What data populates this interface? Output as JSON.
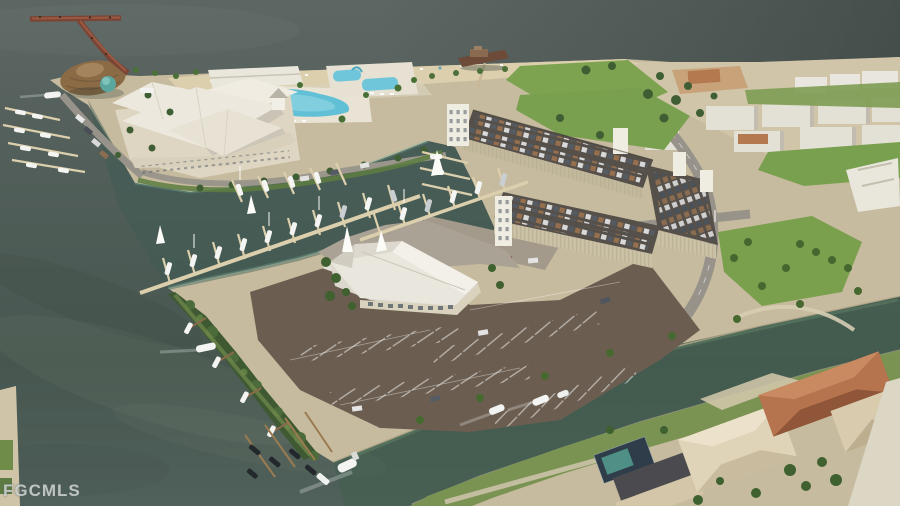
{
  "watermark": {
    "text": "FGCMLS"
  },
  "scene": {
    "type": "aerial-architectural-rendering",
    "description": "Aerial rendering of a coastal marina resort: T-shaped fishing pier, tiki hut, white-roofed clubhouse with resort pools, beach with shipwreck pier, marina docks with boats, dry-stack parking garage with rooftop cars, event hall, large surface parking lot, a canal with passing boats, and waterfront homes",
    "features": [
      "open-water",
      "fishing-pier",
      "tiki-hut",
      "clubhouse",
      "resort-pools",
      "beach",
      "shipwreck-pier",
      "event-lawn",
      "marina-docks",
      "sailboats",
      "parking-garage",
      "rooftop-parking",
      "event-hall",
      "surface-parking-lot",
      "access-roads",
      "canal",
      "canal-boats",
      "residential-homes",
      "mangrove-shoreline"
    ]
  },
  "palette": {
    "water_top": "#5e6663",
    "water_bay": "#47554f",
    "water_marina": "#3c5a52",
    "water_canal": "#40604e",
    "sand_beach": "#dccfae",
    "ground_tan": "#c6bb9e",
    "grass": "#7da350",
    "lot_brown": "#6b5e51",
    "road_gray": "#98938a",
    "roof_white": "#ece8dd",
    "roof_terracotta": "#b5744e",
    "garage_wall": "#cbc1a6",
    "garage_deck": "#56504a",
    "tiki_thatch": "#8a6b46",
    "pier_wood": "#7c4434",
    "pool_cyan": "#62c0d6",
    "tree_green": "#3f5e33",
    "boat_white": "#f4f5f2"
  }
}
